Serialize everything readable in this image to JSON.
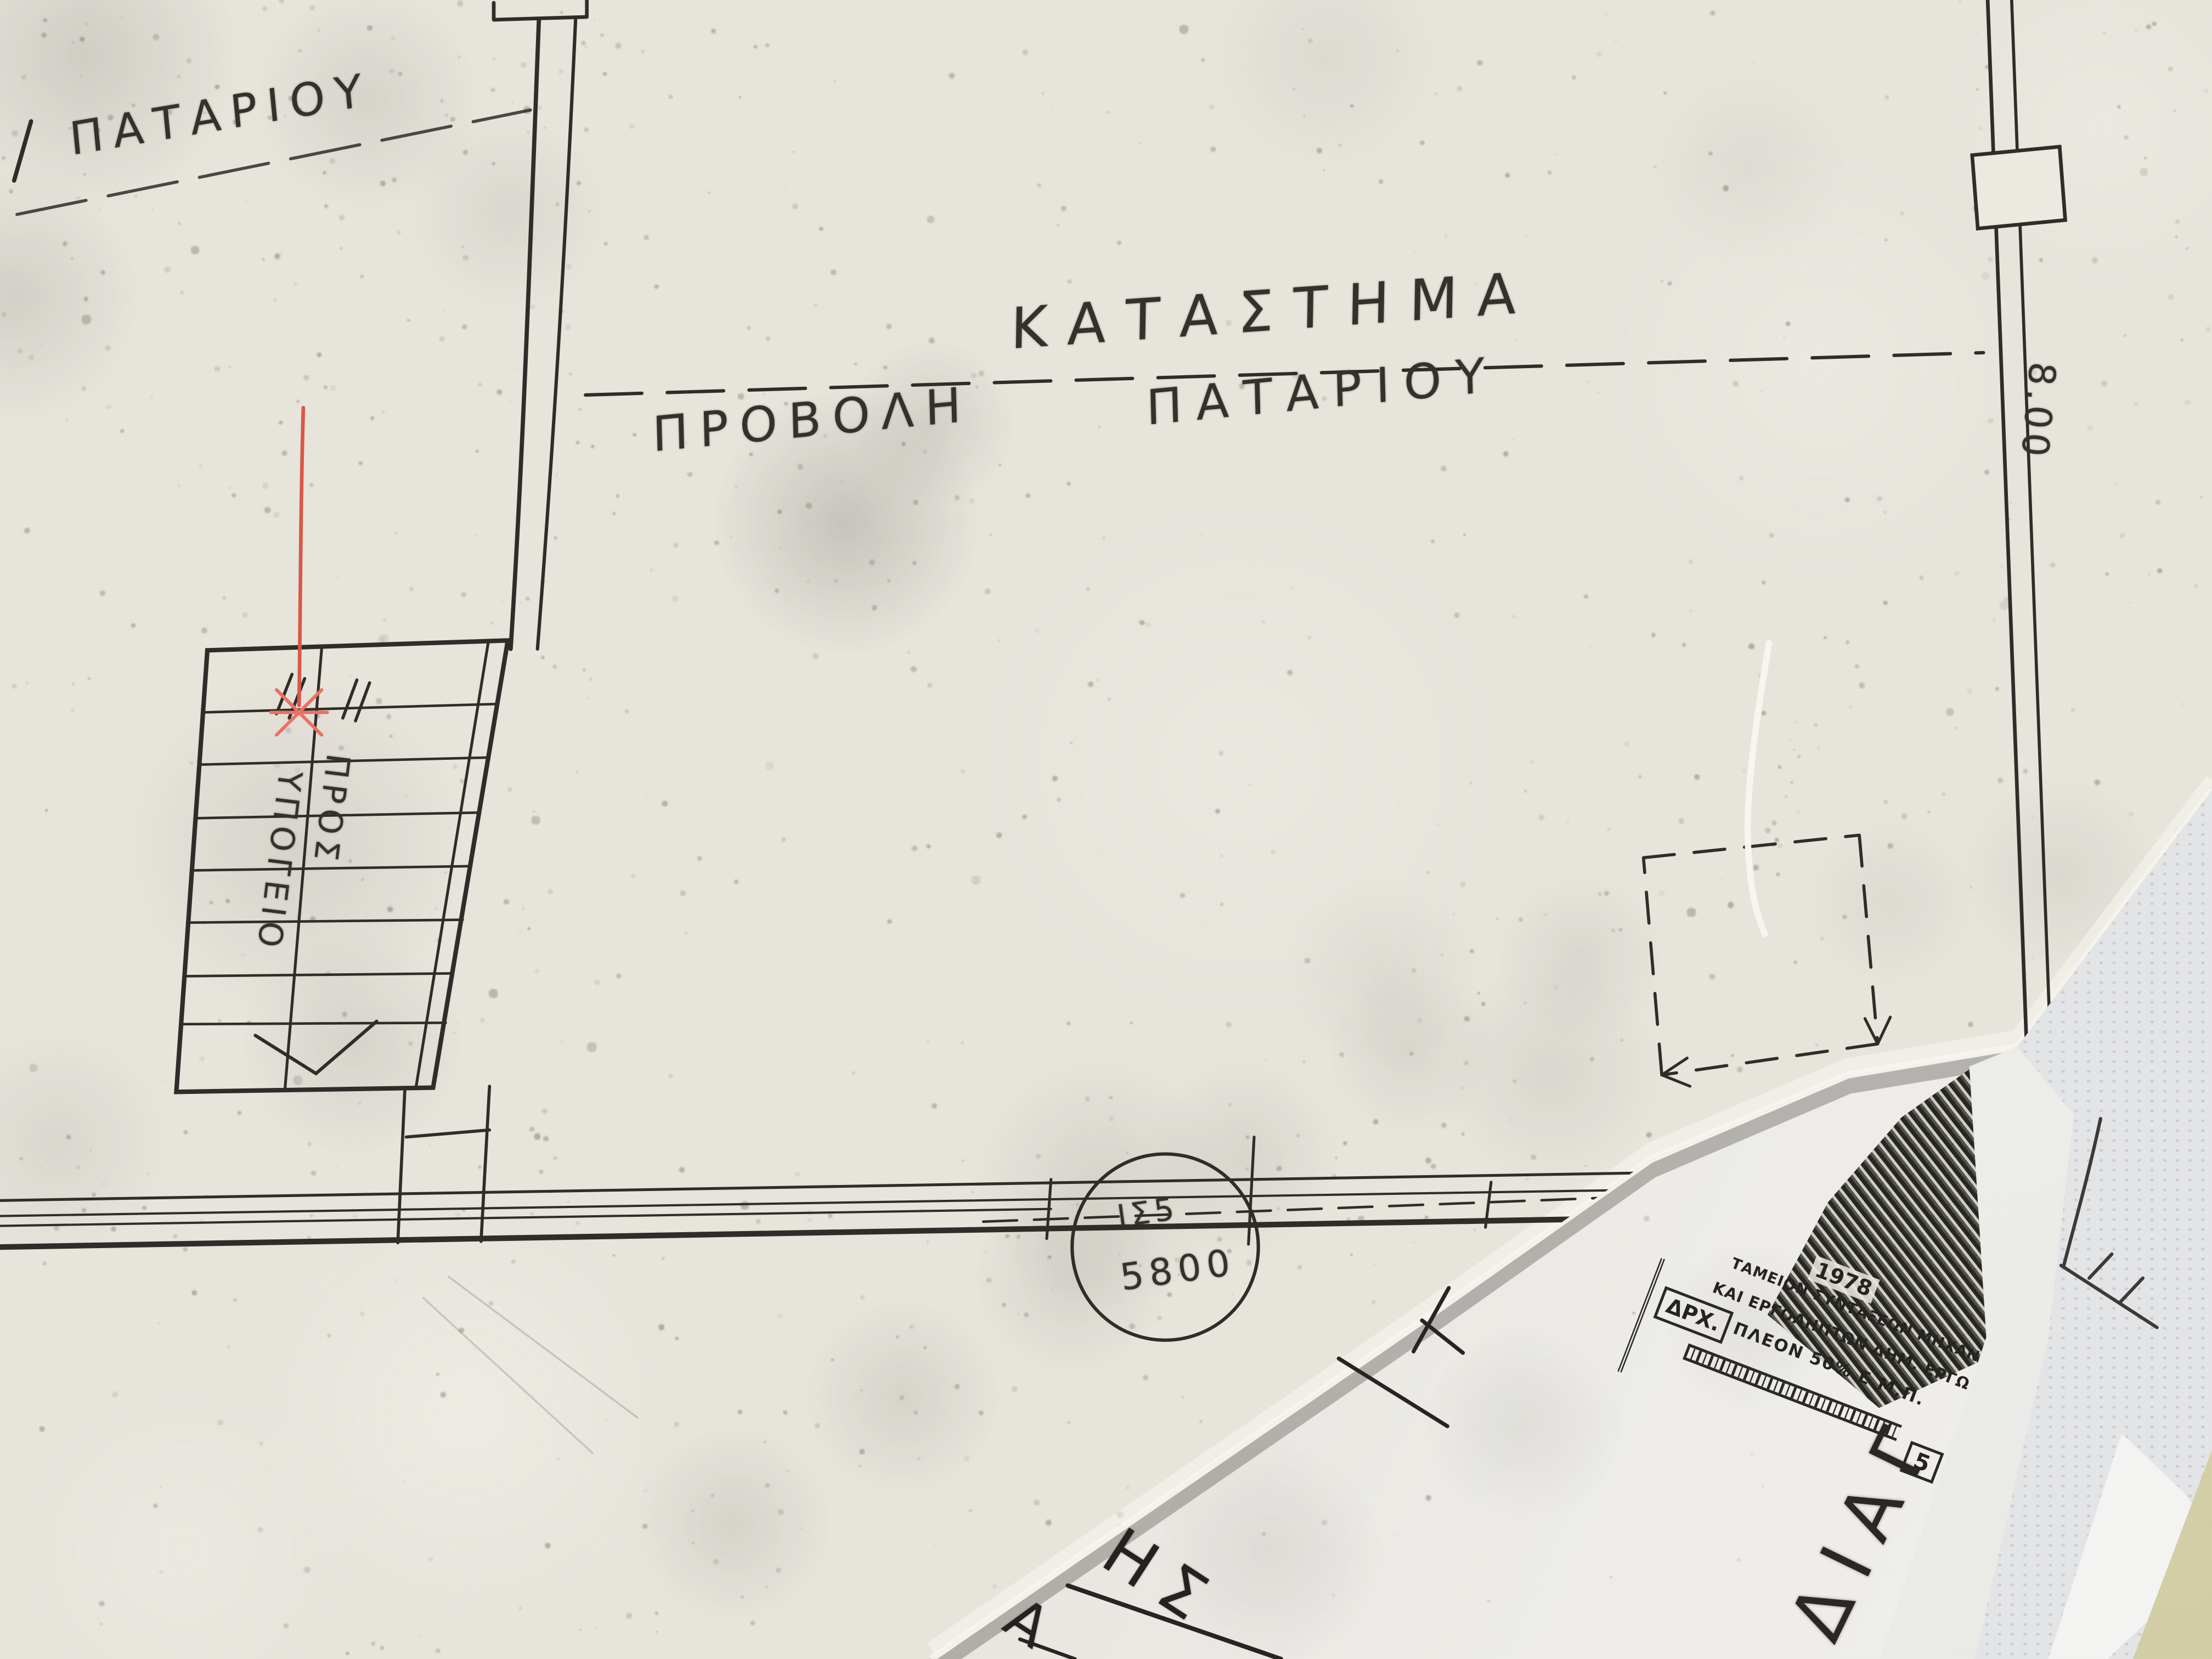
{
  "plan": {
    "boundary_label": "ΠΑΤΑΡΙΟΥ",
    "room_label": "ΚΑΤΑΣΤΗΜΑ",
    "projection_label_1": "ΠΡΟΒΟΛΗ",
    "projection_label_2": "ΠΑΤΑΡΙΟΥ",
    "dimension_right": "8.00",
    "stairs_label_1": "ΠΡΟΣ",
    "stairs_label_2": "ΥΠΟΓΕΙΟ",
    "level_marker": {
      "top": "ΙΣ5",
      "bottom": "5800"
    }
  },
  "under_sheet": {
    "partial_letter": "Α",
    "partial_word": "ΗΣ",
    "big_title_partial": "ΔΙΑΓ"
  },
  "stamp": {
    "year": "1978",
    "line1": "ΤΑΜΕΙΟΝ ΣΥΝΤΑΞΕΩΝ ΜΗΧΑΝΙΚΩΝ",
    "line2": "ΚΑΙ ΕΡΓΟΛΗΠΤΩΝ ΔΗΜ. ΕΡΓΩΝ Σ",
    "line3": "ΠΛΕΟΝ 50% Ε.Μ.Π.",
    "currency": "ΔΡΧ.",
    "denomination": "5"
  },
  "colors": {
    "ink": "#2f2d29",
    "red_mark": "#d95848",
    "paper_top": "#e8e5dd",
    "paper_under": "#dcd9d3",
    "desk": "#d8d3ae"
  }
}
